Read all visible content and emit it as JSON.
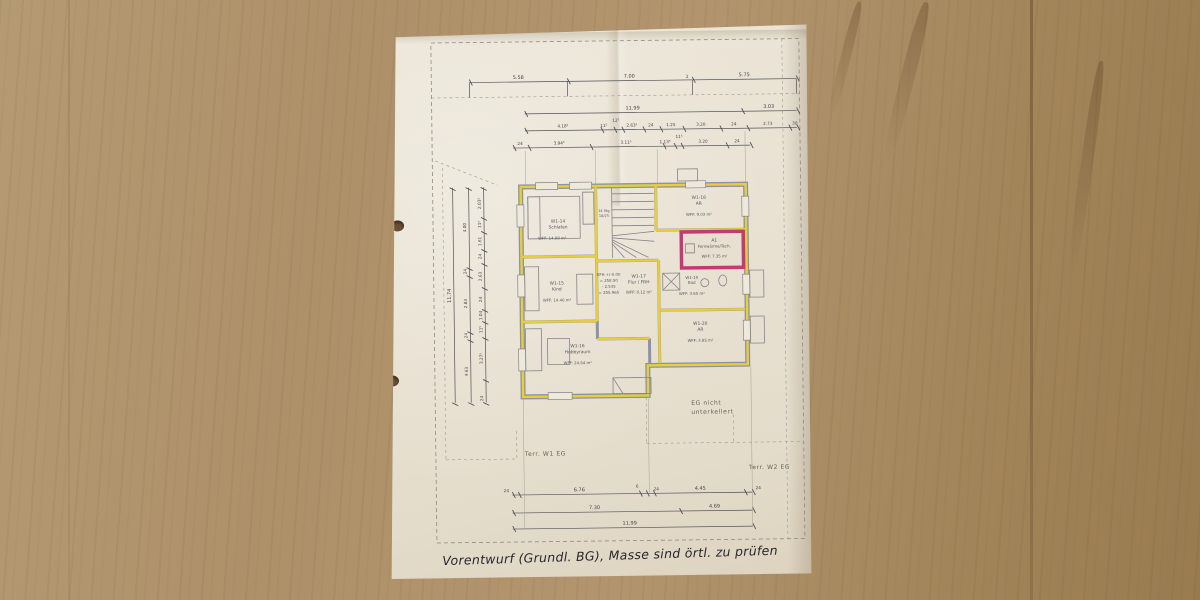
{
  "photo": {
    "handwritten_note": "Vorentwurf (Grundl. BG), Masse sind örtl. zu prüfen"
  },
  "plan": {
    "rooms": {
      "schlafen": {
        "id": "W1-14",
        "name": "Schlafen",
        "area": "WFF: 14.88 m²"
      },
      "kind": {
        "id": "W1-15",
        "name": "Kind",
        "area": "WFF: 14.46 m²"
      },
      "hobbyraum": {
        "id": "W1-16",
        "name": "Hobbyraum",
        "area": "WFF: 24.64 m²"
      },
      "flur": {
        "id": "W1-17",
        "name": "Flur / FRH",
        "area": "WFF: 8.12 m²"
      },
      "ar_nord": {
        "id": "W1-18",
        "name": "AR",
        "area": "WFF: 9.03 m²"
      },
      "bad": {
        "id": "W1-19",
        "name": "Bad",
        "area": "WFF: 3.65 m²"
      },
      "ar_sued": {
        "id": "W1-20",
        "name": "AR",
        "area": "WFF: 3.85 m²"
      },
      "technik": {
        "id": "A1",
        "name": "Fernwärme/Tech.",
        "area": "WFF: 7.35 m²"
      }
    },
    "stair": {
      "line1": "14 Stg",
      "line2": "18/25"
    },
    "elevation": {
      "l1": "EFH +/-0.00",
      "l2": "= 258.50",
      "l3": "- 2.535",
      "l4": "= 255.965"
    },
    "annotations": {
      "eg_line1": "EG nicht",
      "eg_line2": "unterkellert",
      "terrace_w1": "Terr. W1 EG",
      "terrace_w2": "Terr. W2 EG"
    },
    "dims": {
      "t1": [
        "5.58",
        "7.00",
        "2",
        "5.75"
      ],
      "t2": [
        "11.99",
        "3.03"
      ],
      "t3": [
        "4.18⁵",
        "11⁵",
        "12⁵",
        "2.63⁵",
        "24",
        "1.25",
        "3.20",
        "24",
        "2.73",
        "30"
      ],
      "t4": [
        "24",
        "3.94⁵",
        "3.11⁵",
        "1.13⁵",
        "11⁵",
        "3.20",
        "24"
      ],
      "l_outer": "11.74",
      "l_mid": [
        "4.00",
        "24",
        "2.83",
        "24",
        "4.63"
      ],
      "l_inner": [
        "2.03⁵",
        "11⁵",
        "1.61",
        "24",
        "2.63",
        "24",
        "1.04",
        "11⁵",
        "3.27⁵",
        "24"
      ],
      "b1": [
        "24",
        "6.76",
        "6",
        "24",
        "4.45",
        "24"
      ],
      "b2": [
        "7.30",
        "4.69"
      ],
      "b3": [
        "11.99"
      ]
    },
    "colors": {
      "wall": "#8d93a3",
      "highlight": "#e8cf3a",
      "technik_border": "#c23b76",
      "paper": "#e9e2d4"
    }
  }
}
